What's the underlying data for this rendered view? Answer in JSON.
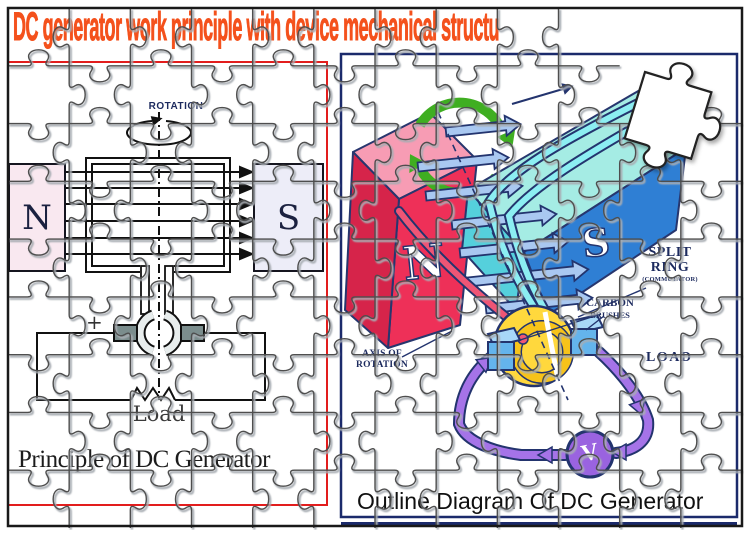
{
  "banner": {
    "title": "DC generator work principle with device mechanical structu"
  },
  "left_panel": {
    "rotation_label": "ROTATION",
    "magnet_n": "N",
    "magnet_s": "S",
    "plus_sign": "+",
    "load_label": "Load",
    "caption": "Principle of DC Generator"
  },
  "right_panel": {
    "magnet_n": "N",
    "magnet_s": "S",
    "labels": {
      "axis_line1": "AXIS OF",
      "axis_line2": "ROTATION",
      "split_ring_line1": "SPLIT",
      "split_ring_line2": "RING",
      "split_ring_sub": "(COMMUTATOR)",
      "carbon_line1": "CARBON",
      "carbon_line2": "BRUSHES",
      "load": "LOAD",
      "voltmeter": "V"
    },
    "caption": "Outline Diagram Of DC Generator"
  },
  "colors": {
    "title_orange": "#f4511c",
    "left_border_red": "#e21d1d",
    "panel_navy": "#1b2a6b",
    "magnet_n_red": "#ee3058",
    "magnet_n_top_pink": "#f79cb4",
    "magnet_s_blue": "#2f7fd4",
    "magnet_s_cyan": "#55d0dc",
    "magnet_s_top_aqua": "#a5ece4",
    "rotation_green": "#3fae21",
    "field_arrow_blue": "#a9c8f1",
    "commutator_gold": "#ffd83d",
    "brush_blue": "#64b4ec",
    "circuit_purple": "#a573e8",
    "voltmeter_purple": "#9a63e0"
  }
}
